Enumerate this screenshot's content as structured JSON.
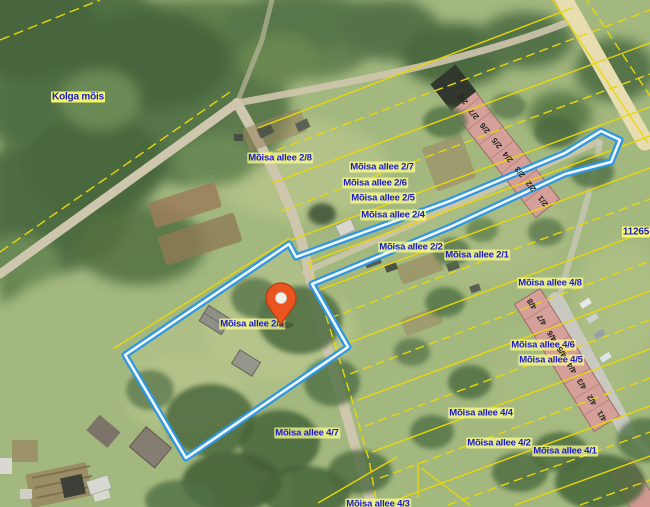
{
  "map": {
    "place_name": "Kolga mõis",
    "road_number": "11265",
    "selected_parcel": {
      "address": "Mõisa allee 2/3",
      "outline_color": "#2f96e0"
    },
    "marker": {
      "address": "Mõisa allee 2/3",
      "x": 281,
      "y": 325,
      "color": "#e9541f"
    },
    "colors": {
      "cadastral_line": "#e9d60b",
      "selected_outline": "#2f96e0",
      "label_text": "#1c1ccf",
      "label_background": "#ffff8c",
      "building": "#d5a099",
      "road": "#cfc7ad",
      "highway": "#e7ddb0",
      "grass": "#a3b87f"
    },
    "labels": [
      {
        "text": "Kolga mõis",
        "cx": 78,
        "cy": 97,
        "boxed": true
      },
      {
        "text": "Mõisa allee 2/8",
        "cx": 280,
        "cy": 158
      },
      {
        "text": "Mõisa allee 2/7",
        "cx": 382,
        "cy": 167
      },
      {
        "text": "Mõisa allee 2/6",
        "cx": 375,
        "cy": 183
      },
      {
        "text": "Mõisa allee 2/5",
        "cx": 383,
        "cy": 198
      },
      {
        "text": "Mõisa allee 2/4",
        "cx": 393,
        "cy": 215
      },
      {
        "text": "Mõisa allee 2/2",
        "cx": 411,
        "cy": 247
      },
      {
        "text": "Mõisa allee 2/1",
        "cx": 477,
        "cy": 255
      },
      {
        "text": "Mõisa allee 2/3",
        "cx": 252,
        "cy": 324
      },
      {
        "text": "Mõisa allee 4/8",
        "cx": 550,
        "cy": 283
      },
      {
        "text": "Mõisa allee 4/6",
        "cx": 543,
        "cy": 345
      },
      {
        "text": "Mõisa allee 4/5",
        "cx": 551,
        "cy": 360
      },
      {
        "text": "Mõisa allee 4/4",
        "cx": 481,
        "cy": 413
      },
      {
        "text": "Mõisa allee 4/2",
        "cx": 499,
        "cy": 443
      },
      {
        "text": "Mõisa allee 4/1",
        "cx": 565,
        "cy": 451
      },
      {
        "text": "Mõisa allee 4/7",
        "cx": 307,
        "cy": 433
      },
      {
        "text": "Mõisa allee 4/3",
        "cx": 378,
        "cy": 504
      },
      {
        "text": "11265",
        "cx": 636,
        "cy": 232,
        "boxed": true
      }
    ],
    "row_buildings": [
      {
        "name": "building-2",
        "rot": -128,
        "units": [
          {
            "t": "2/8",
            "x": 463,
            "y": 99
          },
          {
            "t": "2/7",
            "x": 474,
            "y": 114
          },
          {
            "t": "2/6",
            "x": 485,
            "y": 128
          },
          {
            "t": "2/5",
            "x": 497,
            "y": 143
          },
          {
            "t": "2/4",
            "x": 508,
            "y": 157
          },
          {
            "t": "2/3",
            "x": 520,
            "y": 172
          },
          {
            "t": "2/2",
            "x": 531,
            "y": 186
          },
          {
            "t": "2/1",
            "x": 543,
            "y": 201
          }
        ]
      },
      {
        "name": "building-4",
        "rot": -122,
        "units": [
          {
            "t": "4/8",
            "x": 532,
            "y": 304
          },
          {
            "t": "4/7",
            "x": 542,
            "y": 320
          },
          {
            "t": "4/6",
            "x": 552,
            "y": 336
          },
          {
            "t": "4/5",
            "x": 562,
            "y": 352
          },
          {
            "t": "4/4",
            "x": 572,
            "y": 368
          },
          {
            "t": "4/3",
            "x": 582,
            "y": 384
          },
          {
            "t": "4/2",
            "x": 592,
            "y": 400
          },
          {
            "t": "4/1",
            "x": 602,
            "y": 416
          }
        ]
      }
    ]
  }
}
